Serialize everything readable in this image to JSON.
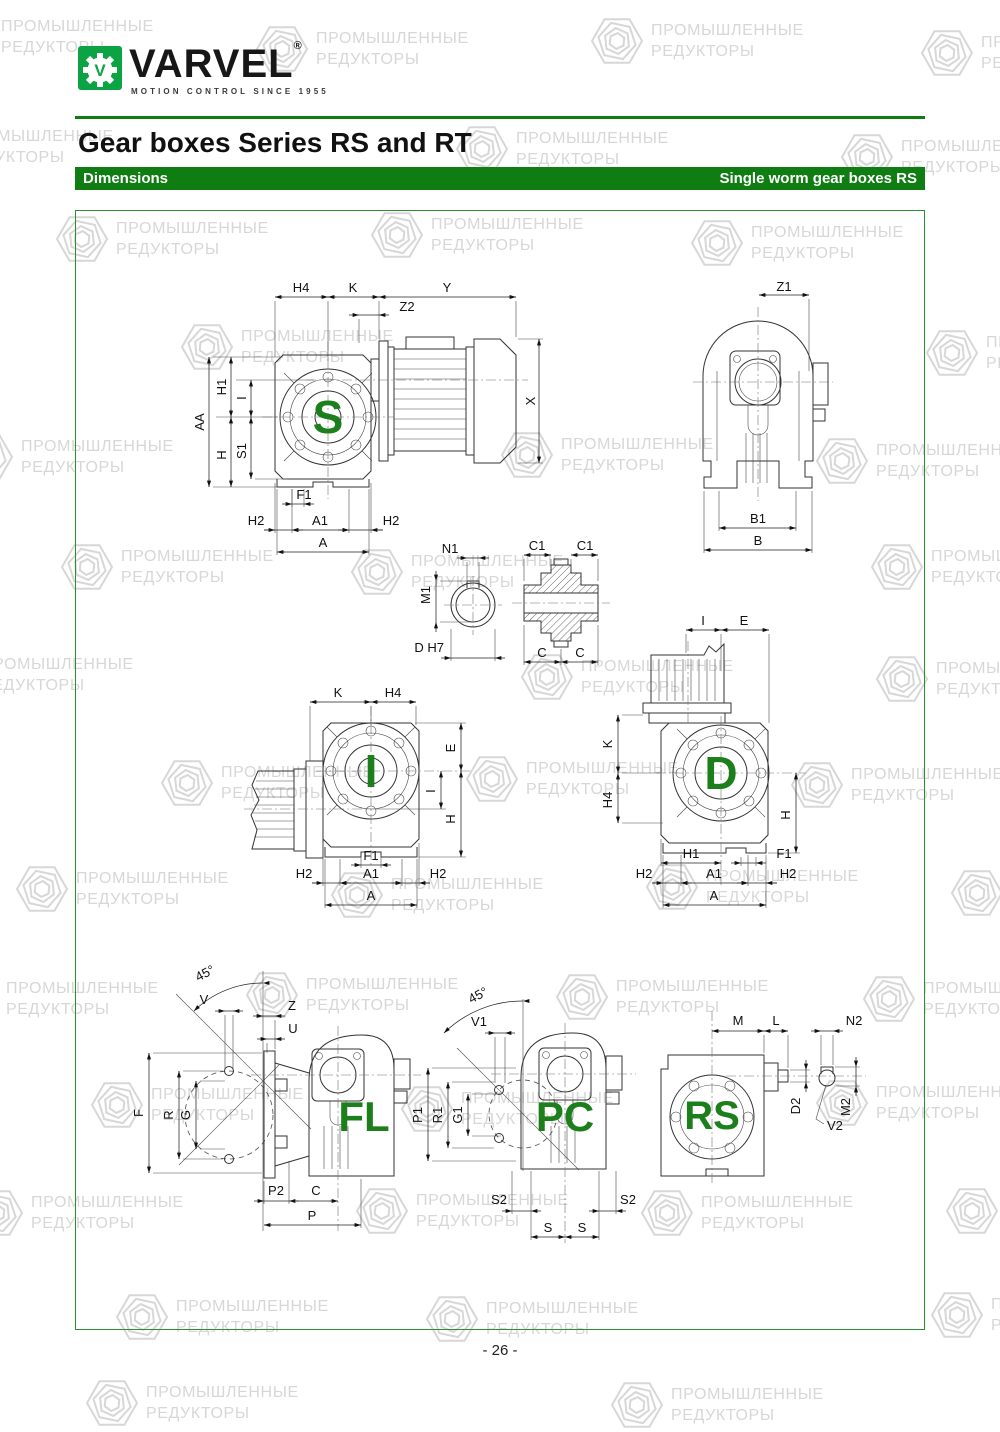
{
  "header": {
    "logo_letter": "V",
    "brand": "VARVEL",
    "registered": "®",
    "tagline": "MOTION CONTROL SINCE 1955",
    "title": "Gear boxes Series RS and RT",
    "bar_left": "Dimensions",
    "bar_right": "Single worm gear boxes RS"
  },
  "watermark": {
    "line1": "ПРОМЫШЛЕННЫЕ",
    "line2": "РЕДУКТОРЫ"
  },
  "footer": {
    "page_number": "- 26 -"
  },
  "colors": {
    "bar_green": "#0f7d11",
    "logo_green": "#0ba344",
    "letter_green": "#1c7f1c",
    "watermark_gray": "#d7d7d7",
    "border_green": "#2d8f2d"
  },
  "drawings": {
    "s": {
      "letter": "S",
      "dims": {
        "h4": "H4",
        "k": "K",
        "y": "Y",
        "z2": "Z2",
        "x": "X",
        "h1": "H1",
        "i": "I",
        "aa": "AA",
        "h": "H",
        "s1": "S1",
        "f1": "F1",
        "h2_left": "H2",
        "a1": "A1",
        "h2_right": "H2",
        "a": "A"
      }
    },
    "rear": {
      "dims": {
        "z1": "Z1",
        "b1": "B1",
        "b": "B"
      }
    },
    "shaft_detail": {
      "dims": {
        "n1": "N1",
        "m1": "M1",
        "d_h7": "D H7",
        "c1_left": "C1",
        "c1_right": "C1",
        "c_left": "C",
        "c_right": "C"
      }
    },
    "i": {
      "letter": "I",
      "dims": {
        "k": "K",
        "h4": "H4",
        "e": "E",
        "i": "I",
        "h": "H",
        "f1": "F1",
        "h2_left": "H2",
        "a1": "A1",
        "h2_right": "H2",
        "a": "A"
      }
    },
    "d": {
      "letter": "D",
      "dims": {
        "i": "I",
        "e": "E",
        "k": "K",
        "h4": "H4",
        "h": "H",
        "h1": "H1",
        "f1": "F1",
        "h2_left": "H2",
        "a1": "A1",
        "h2_right": "H2",
        "a": "A"
      }
    },
    "fl": {
      "letter": "FL",
      "dims": {
        "angle": "45°",
        "v": "V",
        "z": "Z",
        "u": "U",
        "f": "F",
        "r": "R",
        "g": "G",
        "p2": "P2",
        "c": "C",
        "p": "P"
      }
    },
    "pc": {
      "letter": "PC",
      "dims": {
        "angle": "45°",
        "v1": "V1",
        "p1": "P1",
        "r1": "R1",
        "g1": "G1",
        "s2_left": "S2",
        "s2_right": "S2",
        "s_left": "S",
        "s_right": "S"
      }
    },
    "rs": {
      "letter": "RS",
      "dims": {
        "m": "M",
        "l": "L",
        "n2": "N2",
        "d2": "D2",
        "m2": "M2",
        "v2": "V2"
      }
    }
  }
}
